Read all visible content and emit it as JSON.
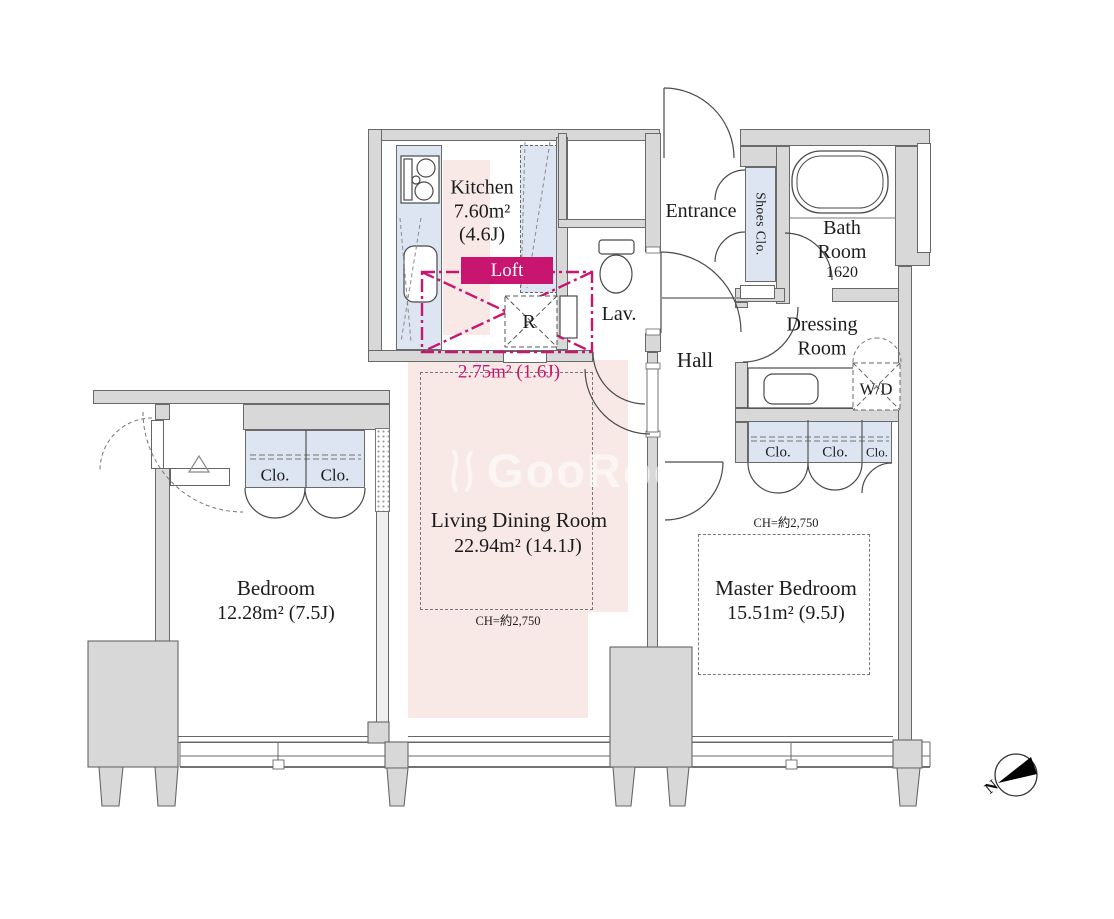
{
  "colors": {
    "accent": "#C8156F",
    "pink": "#F8E9E7",
    "blue": "#DCE5F1",
    "wall": "#D8D8D8",
    "line": "#555555"
  },
  "rooms": {
    "kitchen": {
      "name": "Kitchen",
      "area": "7.60m²",
      "tatami": "(4.6J)"
    },
    "loft": {
      "label": "Loft",
      "storage_label": "R",
      "area": "2.75m² (1.6J)"
    },
    "lavatory": {
      "name": "Lav."
    },
    "entrance": {
      "name": "Entrance"
    },
    "shoes_closet": {
      "name": "Shoes Clo."
    },
    "bathroom": {
      "line1": "Bath",
      "line2": "Room",
      "size": "1620"
    },
    "dressing_room": {
      "line1": "Dressing",
      "line2": "Room"
    },
    "washer_dryer": {
      "label": "W/D"
    },
    "hall": {
      "name": "Hall"
    },
    "living_dining": {
      "name": "Living Dining Room",
      "area": "22.94m² (14.1J)",
      "ceiling_height": "CH=約2,750"
    },
    "bedroom": {
      "name": "Bedroom",
      "area": "12.28m² (7.5J)"
    },
    "master_bedroom": {
      "name": "Master Bedroom",
      "area": "15.51m² (9.5J)",
      "ceiling_height": "CH=約2,750"
    }
  },
  "closets": {
    "bedroom": [
      "Clo.",
      "Clo."
    ],
    "master": [
      "Clo.",
      "Clo.",
      "Clo."
    ]
  },
  "compass": {
    "north_label": "N"
  },
  "watermark": {
    "text": "GooRooM"
  }
}
